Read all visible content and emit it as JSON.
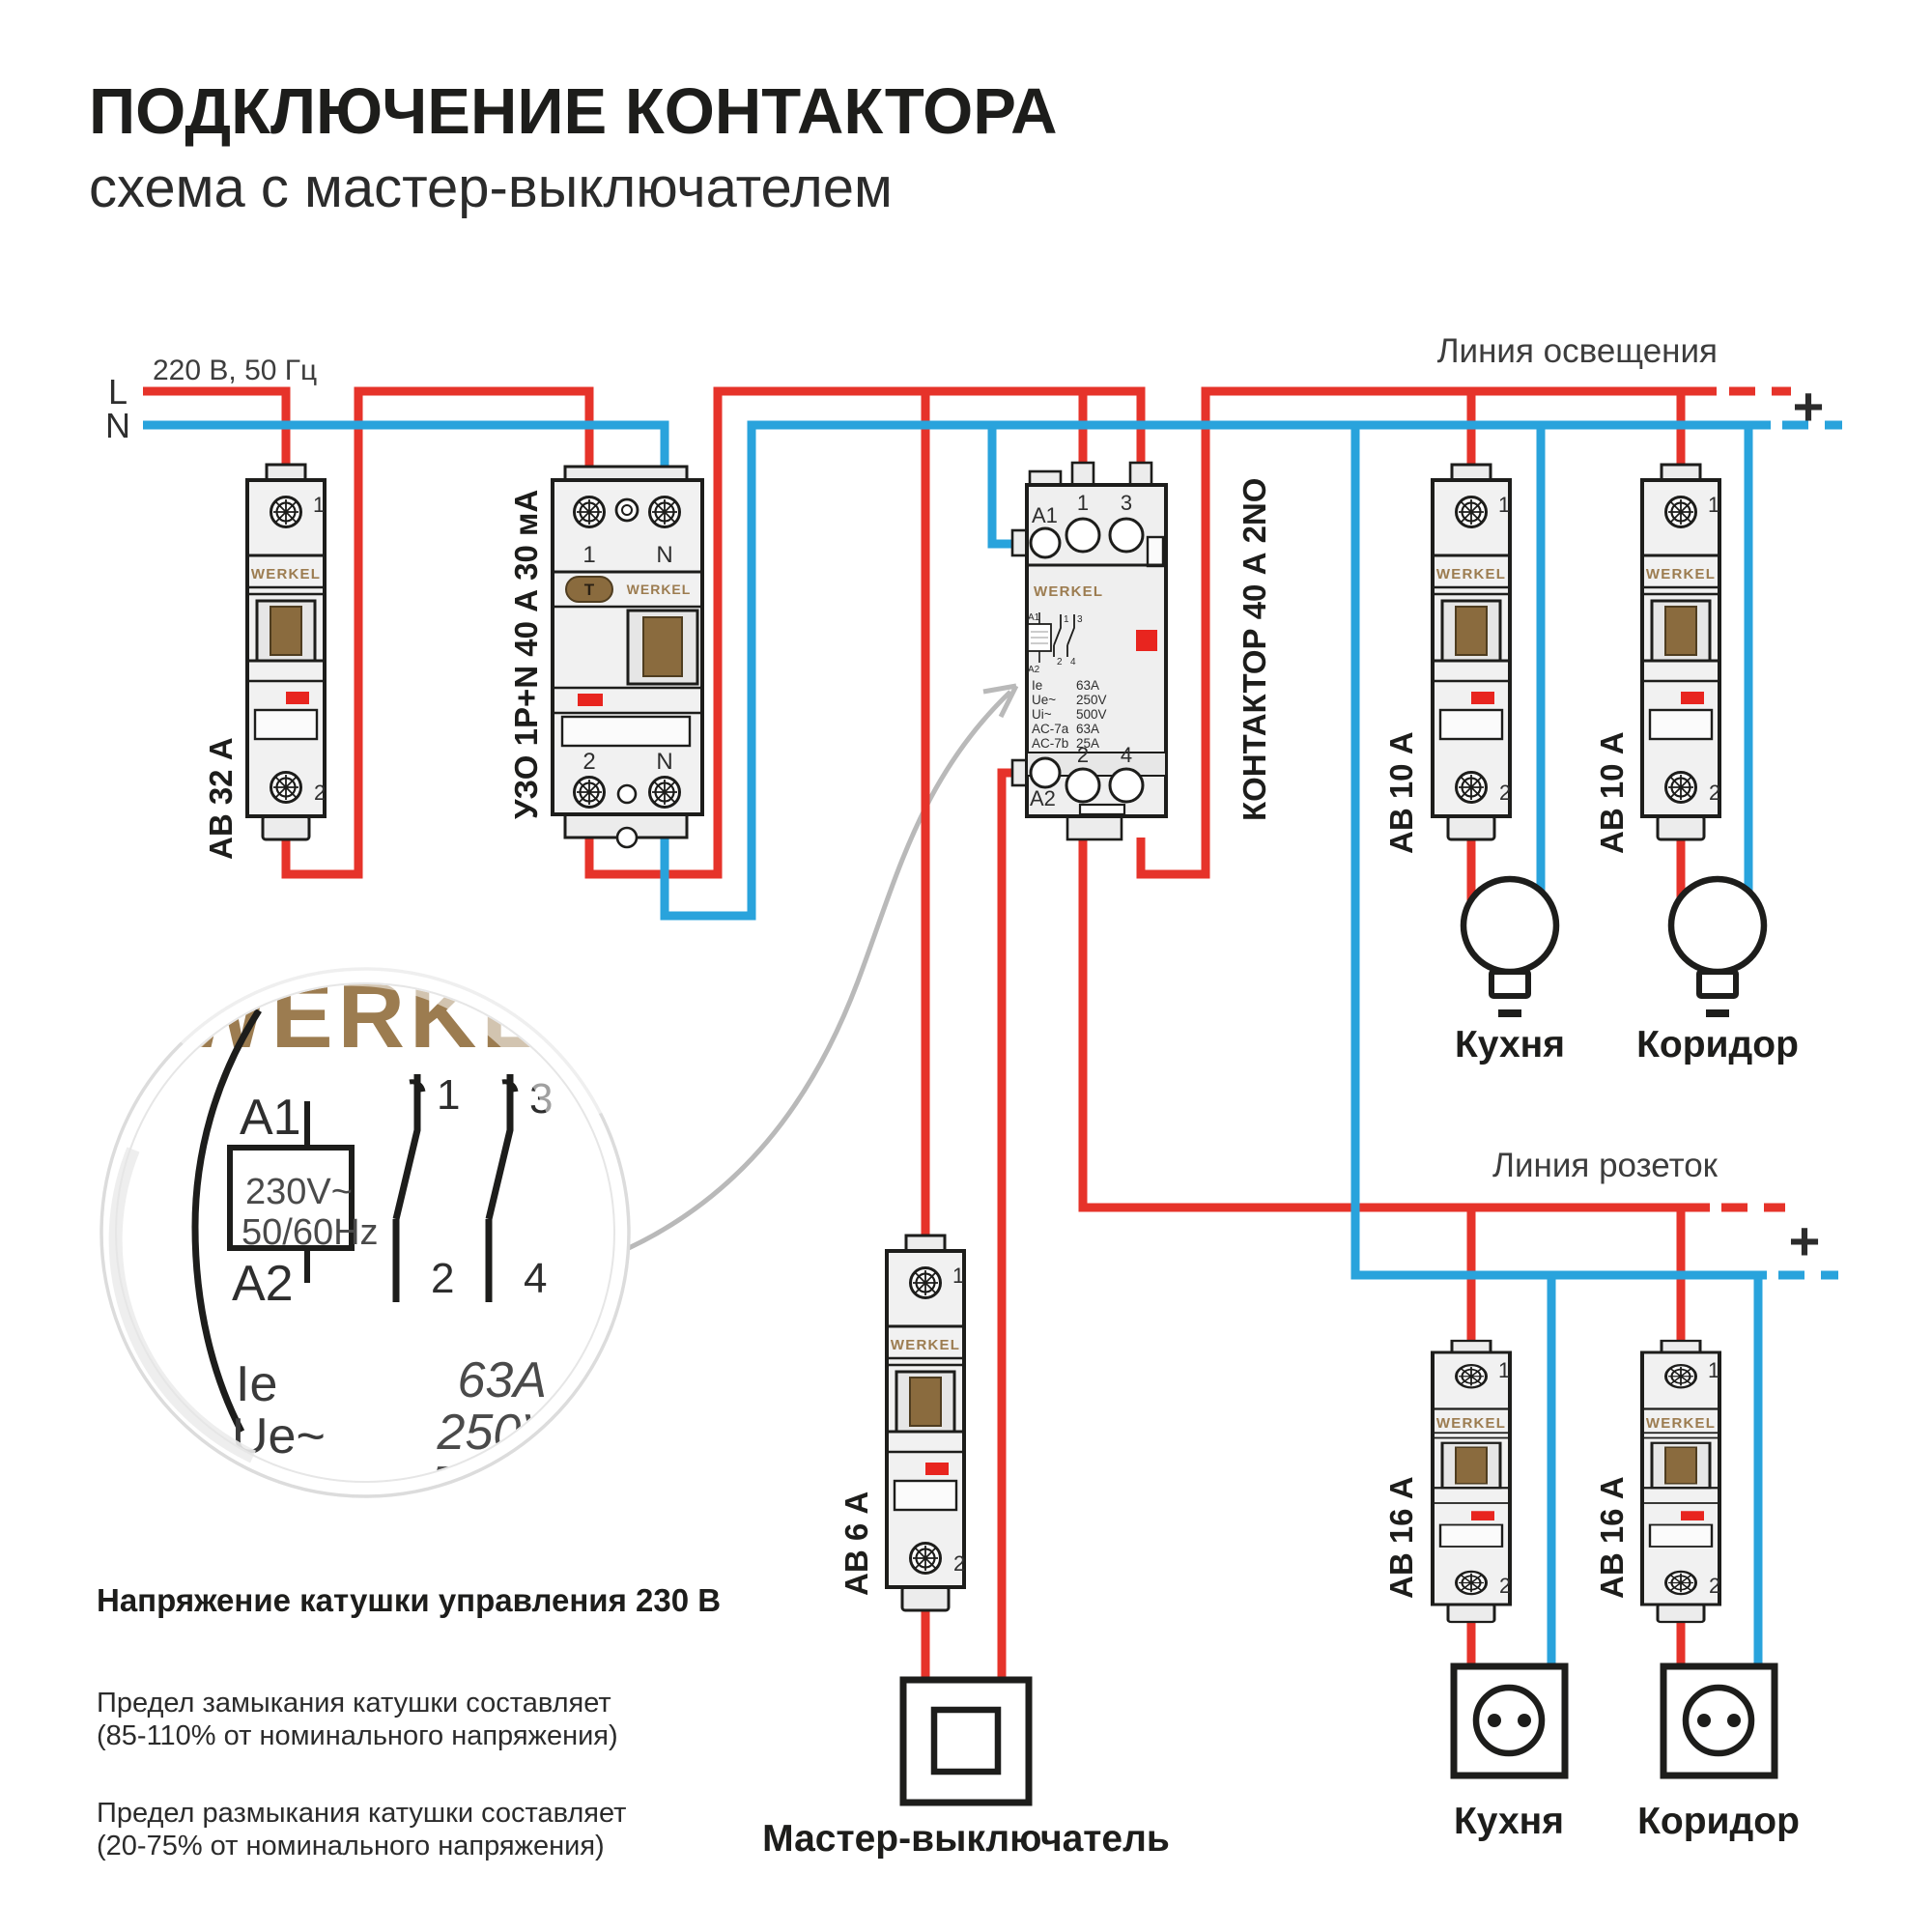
{
  "header": {
    "title": "ПОДКЛЮЧЕНИЕ КОНТАКТОРА",
    "subtitle": "схема с мастер-выключателем"
  },
  "supply": {
    "label": "220 В, 50 Гц",
    "line": "L",
    "neutral": "N"
  },
  "buses": {
    "lighting_label": "Линия освещения",
    "sockets_label": "Линия розеток",
    "plus": "+"
  },
  "brand": "WERKEL",
  "mcb_terminals": {
    "top": "1",
    "bottom": "2"
  },
  "devices": {
    "ab32": {
      "label": "АВ 32 А"
    },
    "uzo": {
      "label": "УЗО 1P+N 40 А 30 мА",
      "test_button": "T",
      "top_left": "1",
      "top_right": "N",
      "bottom_left": "2",
      "bottom_right": "N"
    },
    "contactor": {
      "label": "КОНТАКТОР 40 А 2NO",
      "a1": "A1",
      "a2": "A2",
      "t1": "1",
      "t3": "3",
      "t2": "2",
      "t4": "4",
      "specs": [
        {
          "k": "Ie",
          "v": "63A"
        },
        {
          "k": "Ue~",
          "v": "250V"
        },
        {
          "k": "Ui~",
          "v": "500V"
        },
        {
          "k": "AC-7a",
          "v": "63A"
        },
        {
          "k": "AC-7b",
          "v": "25A"
        }
      ]
    },
    "ab10_kitchen": {
      "label": "АВ 10 А"
    },
    "ab10_corridor": {
      "label": "АВ 10 А"
    },
    "ab6": {
      "label": "АВ 6 А"
    },
    "ab16_kitchen": {
      "label": "АВ 16 А"
    },
    "ab16_corridor": {
      "label": "АВ 16 А"
    }
  },
  "loads": {
    "lamp_kitchen": "Кухня",
    "lamp_corridor": "Коридор",
    "socket_kitchen": "Кухня",
    "socket_corridor": "Коридор",
    "master_switch": "Мастер-выключатель"
  },
  "magnifier": {
    "brand": "WERKEL",
    "a1": "A1",
    "a2": "A2",
    "coil_voltage": "230V~",
    "coil_freq": "50/60Hz",
    "c1": "1",
    "c3": "3",
    "c2": "2",
    "c4": "4",
    "specs": [
      {
        "k": "Ie",
        "v": "63A"
      },
      {
        "k": "Ue~",
        "v": "250V"
      },
      {
        "k": "Ui~",
        "v": "500V"
      }
    ]
  },
  "notes": {
    "heading": "Напряжение катушки управления 230 В",
    "p1": [
      "Предел замыкания катушки составляет",
      "(85-110% от номинального напряжения)"
    ],
    "p2": [
      "Предел размыкания катушки составляет",
      "(20-75% от номинального напряжения)"
    ]
  },
  "colors": {
    "wire_live": "#E6332A",
    "wire_neutral": "#29A3DC",
    "brand_gold": "#9C7C50",
    "indicator_red": "#E8251F",
    "outline": "#1D1D1B"
  }
}
